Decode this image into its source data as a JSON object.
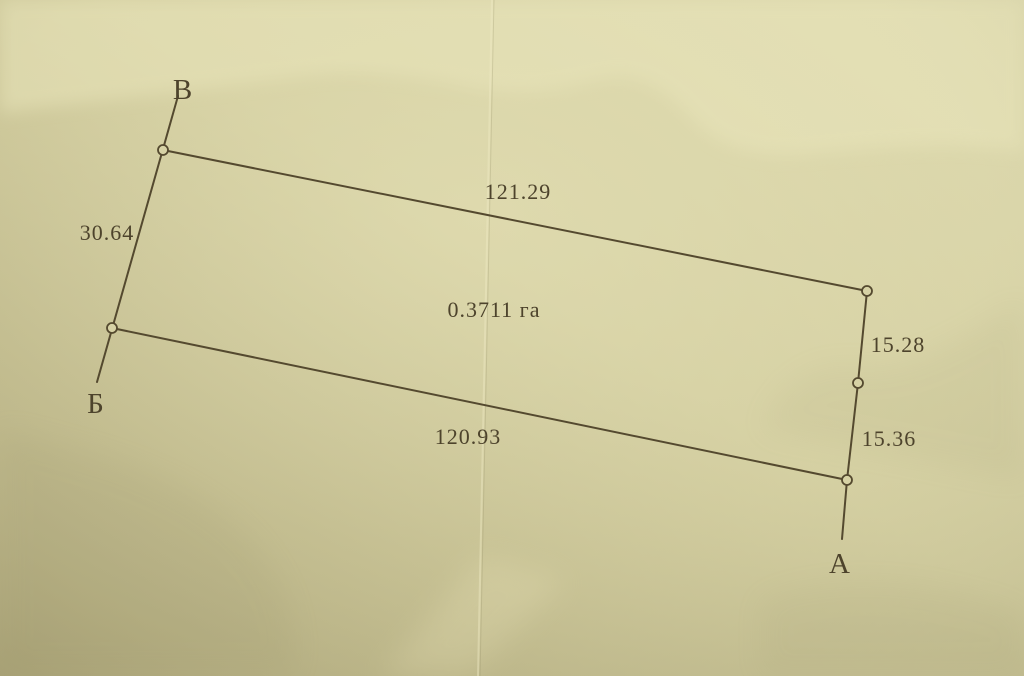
{
  "document": {
    "description": "Photographed land parcel survey plan on beige paper"
  },
  "plan": {
    "area_label": "0.3711 га",
    "vertex_labels": {
      "top_left": "В",
      "bottom_left": "Б",
      "bottom_right": "А"
    },
    "side_lengths": {
      "top": "121.29",
      "left": "30.64",
      "right_upper": "15.28",
      "right_lower": "15.36",
      "bottom": "120.93"
    }
  },
  "colors": {
    "paper_light": "#ddd9ae",
    "paper_mid": "#d3cea0",
    "paper_dark": "#b3ac7f",
    "ink": "#54492f"
  }
}
